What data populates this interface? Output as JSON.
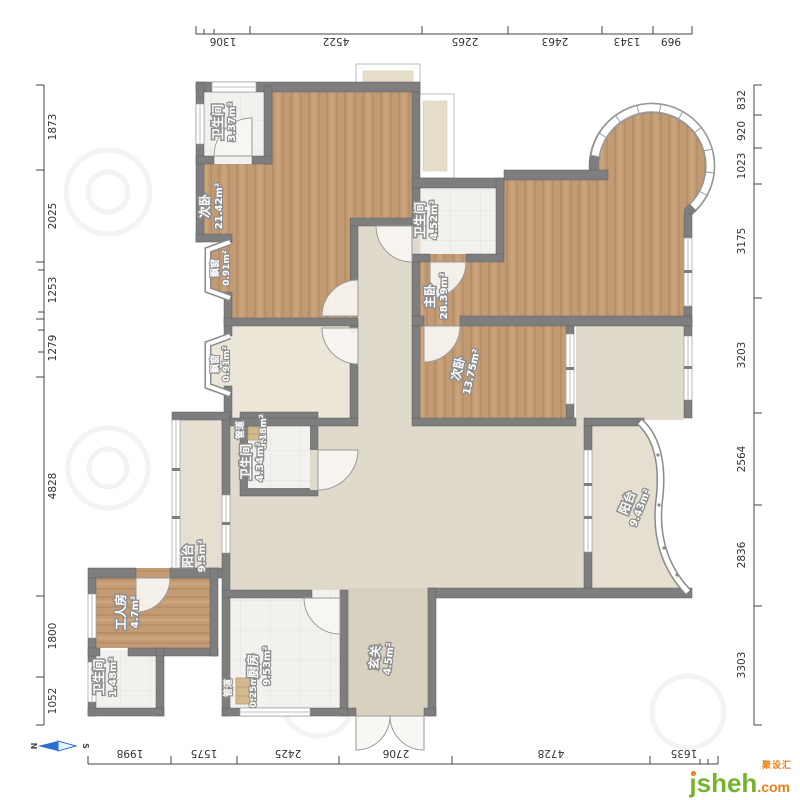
{
  "rulers": {
    "top": {
      "values": [
        "1306",
        "4522",
        "2265",
        "2463",
        "1343",
        "969"
      ]
    },
    "bottom": {
      "values": [
        "1998",
        "1575",
        "2425",
        "2706",
        "4728",
        "1635"
      ]
    },
    "left": {
      "values": [
        "1873",
        "2025",
        "1253",
        "1279",
        "4828",
        "1800",
        "1052"
      ]
    },
    "right": {
      "values": [
        "832",
        "920",
        "1023",
        "3175",
        "3203",
        "2564",
        "2836",
        "3303"
      ]
    }
  },
  "rooms": [
    {
      "label": "卫生间",
      "area": "3.37m²"
    },
    {
      "label": "次卧",
      "area": "21.42m²"
    },
    {
      "label": "飘窗",
      "area": "0.91m²"
    },
    {
      "label": "飘窗",
      "area": "0.91m²"
    },
    {
      "label": "卫生间",
      "area": "4.52m²"
    },
    {
      "label": "主卧",
      "area": "28.39m²"
    },
    {
      "label": "次卧",
      "area": "13.75m²"
    },
    {
      "label": "管道",
      "area": "0.18m²"
    },
    {
      "label": "卫生间",
      "area": "4.34m²"
    },
    {
      "label": "阳台",
      "area": "9.5m²"
    },
    {
      "label": "阳台",
      "area": "9.43m²"
    },
    {
      "label": "工人房",
      "area": "4.7m²"
    },
    {
      "label": "卫生间",
      "area": "1.48m²"
    },
    {
      "label": "管道",
      "area": "0.25m²"
    },
    {
      "label": "厨房",
      "area": "9.53m²"
    },
    {
      "label": "玄关",
      "area": "4.5m²"
    }
  ],
  "compass": {
    "north": "N",
    "south": "S"
  },
  "logo": {
    "brand": "jsheh",
    "suffix": ".com",
    "cn_name": "聚设汇"
  },
  "colors": {
    "wall": "#7e7e7e",
    "wood": "#c29a74",
    "hall_floor": "#e0dacd",
    "tile": "#f2f1ee",
    "balcony_floor": "#e5dfd1",
    "compass_blue": "#2b6fd4",
    "logo_green": "#76b32b",
    "logo_orange": "#f07f17"
  }
}
